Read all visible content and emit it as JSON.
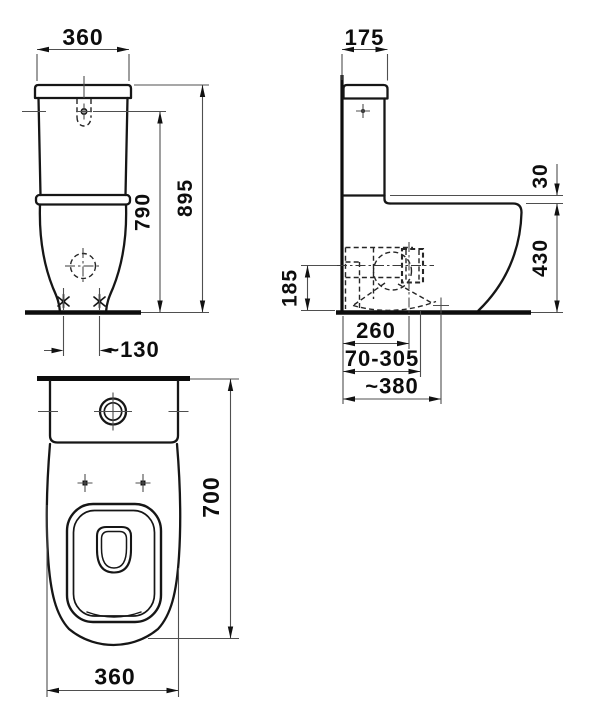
{
  "drawing": {
    "subject": "Close-coupled WC with cistern - dimensional drawing",
    "unit": "mm",
    "colors": {
      "line": "#161616",
      "dimension": "#4f4f4f",
      "background": "#ffffff"
    },
    "views": {
      "front": {
        "name": "Front view",
        "dims": {
          "width": "360",
          "inlet_height": "790",
          "overall_height": "895",
          "fixing_centres": "~130"
        }
      },
      "side": {
        "name": "Side view",
        "dims": {
          "cistern_depth": "175",
          "shelf_to_rim": "30",
          "rim_height": "430",
          "outlet_height": "185",
          "outlet_from_wall": "260",
          "connection_range": "70-305",
          "overall_depth": "~380"
        }
      },
      "top": {
        "name": "Top view",
        "dims": {
          "overall_length": "700",
          "width": "360"
        }
      }
    }
  }
}
